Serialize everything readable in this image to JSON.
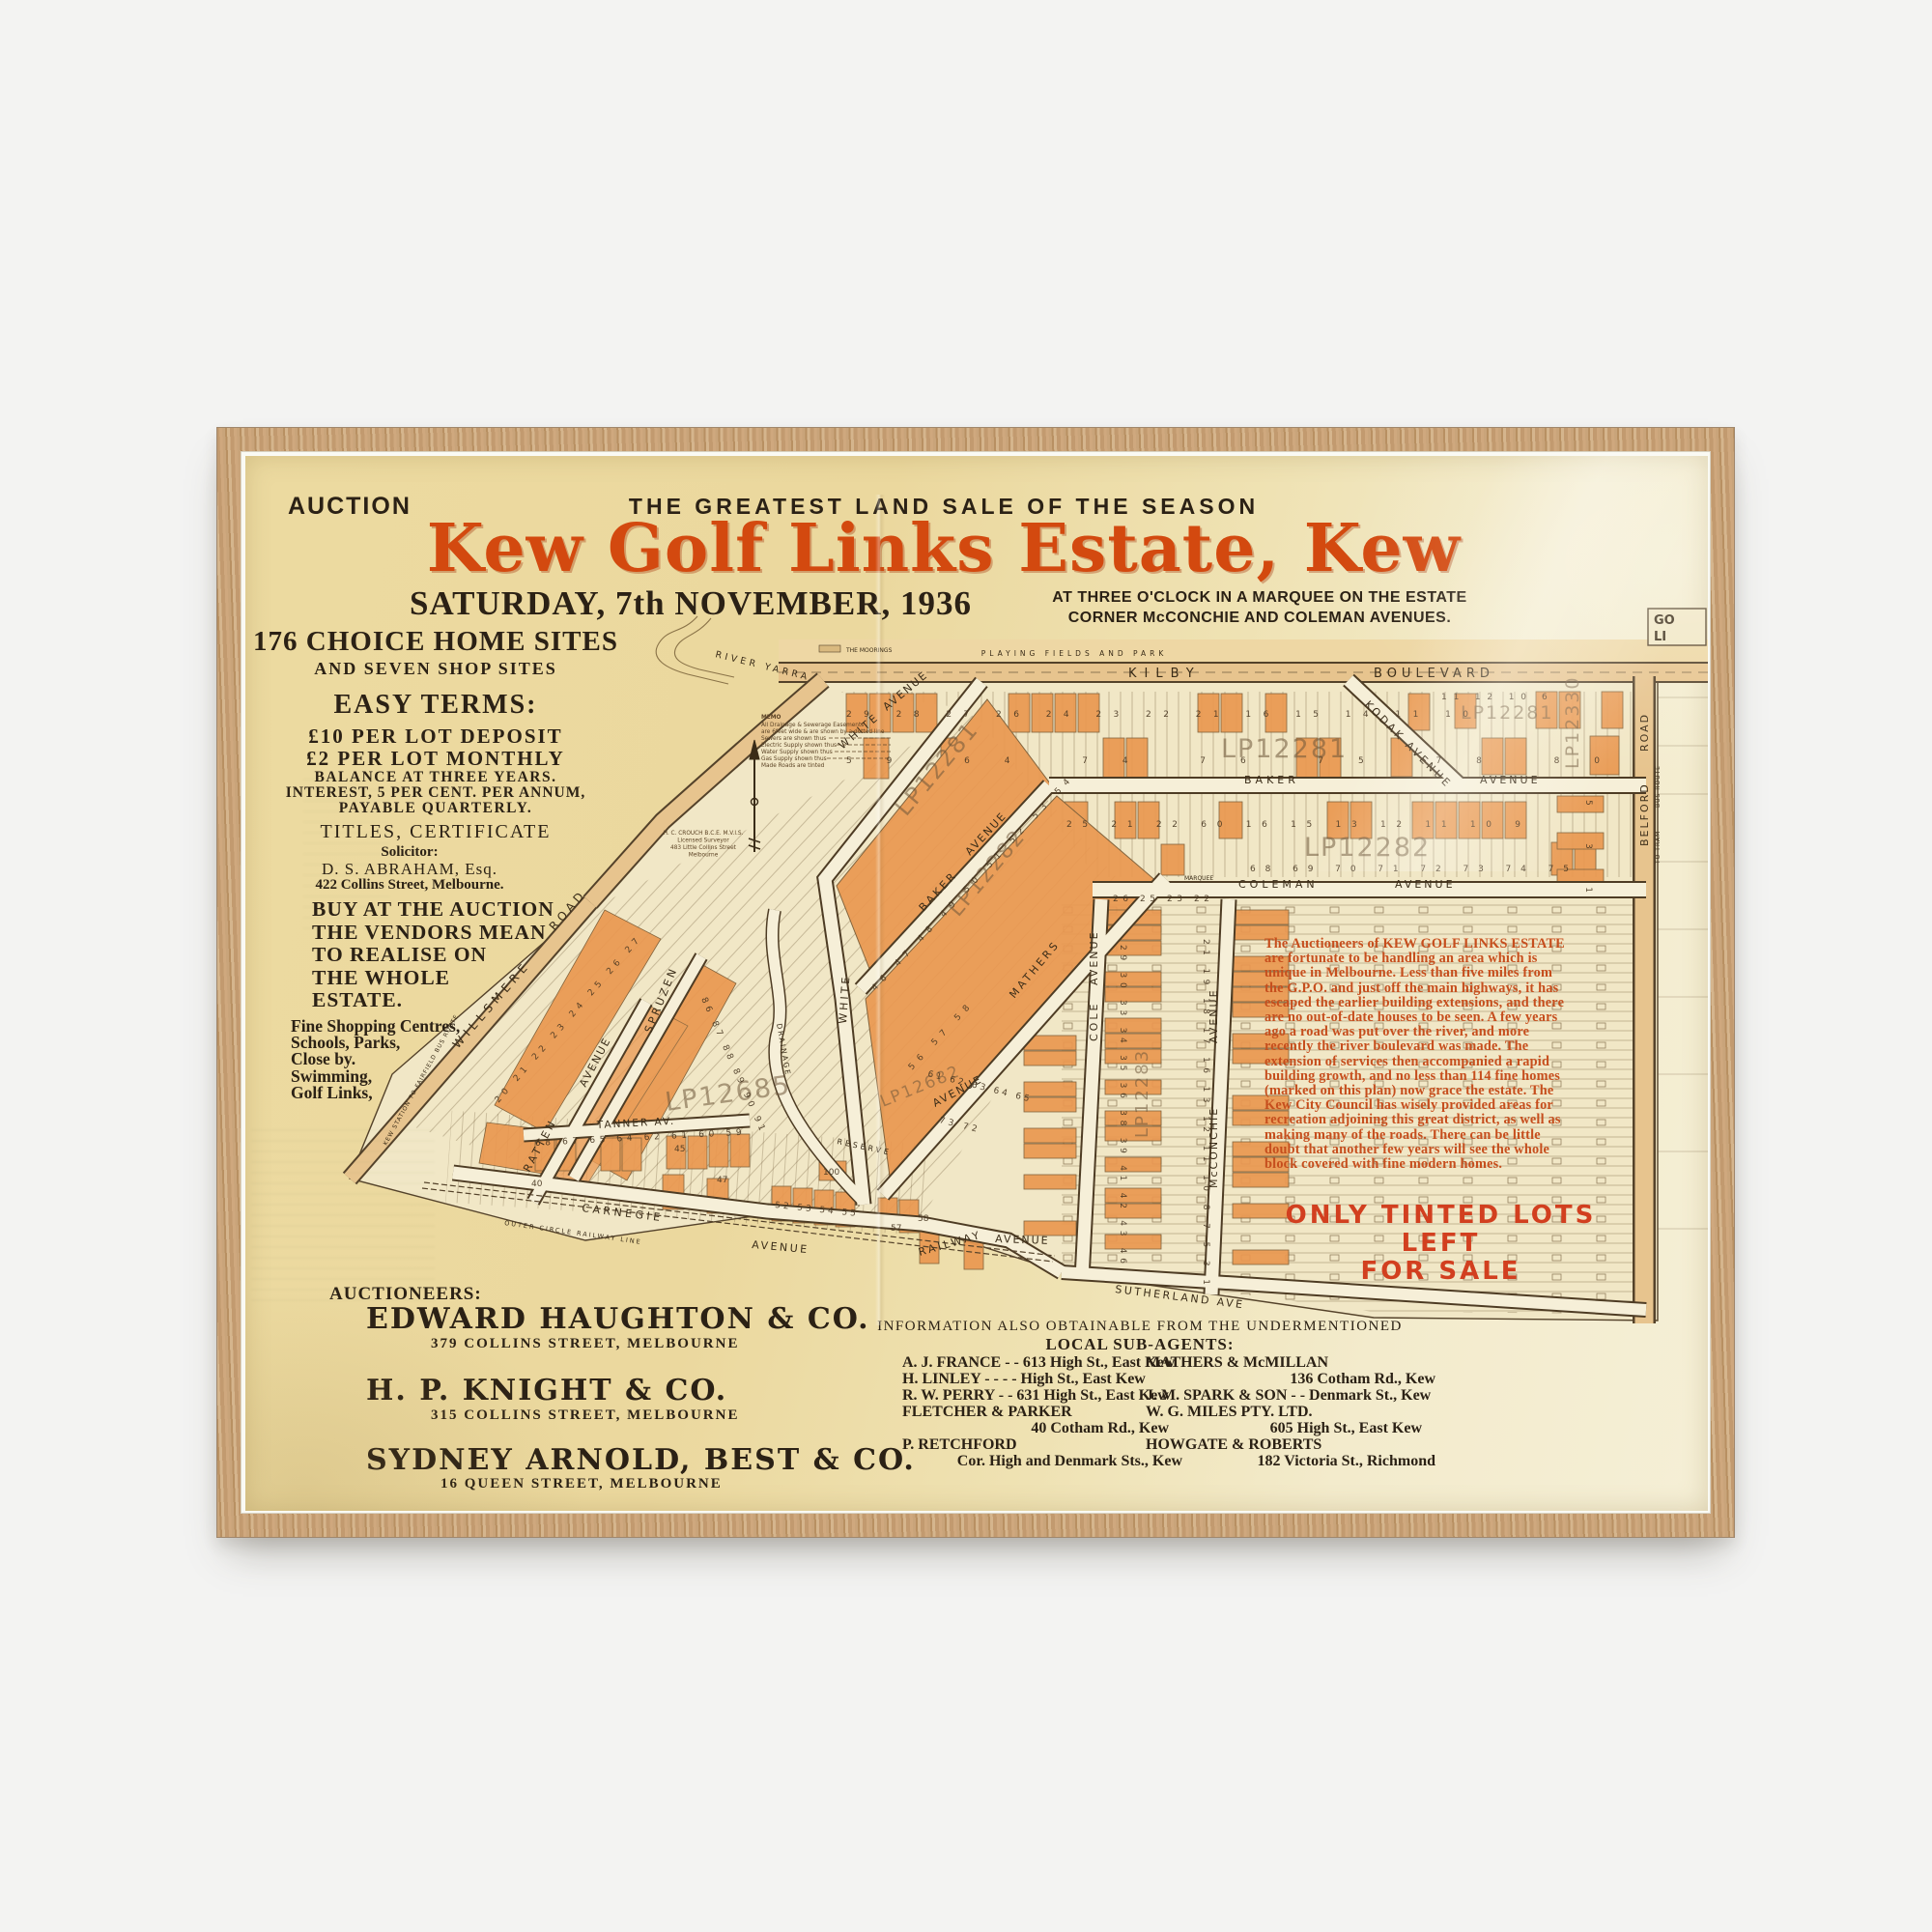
{
  "header": {
    "auction": "AUCTION",
    "tagline": "THE GREATEST LAND SALE OF THE SEASON",
    "title": "Kew Golf Links Estate, Kew",
    "date": "SATURDAY, 7th NOVEMBER, 1936",
    "time_lines": [
      "AT THREE O'CLOCK IN A MARQUEE ON THE ESTATE",
      "CORNER McCONCHIE AND COLEMAN AVENUES."
    ]
  },
  "left": {
    "sites_heading": "176 CHOICE HOME SITES",
    "sites_sub": "AND SEVEN SHOP SITES",
    "easy_terms": "EASY TERMS:",
    "deposit": "£10 PER LOT DEPOSIT",
    "monthly": "£2 PER LOT MONTHLY",
    "balance": "BALANCE AT THREE YEARS.",
    "interest": "INTEREST, 5 PER CENT. PER ANNUM,",
    "payable": "PAYABLE QUARTERLY.",
    "titles": "TITLES, CERTIFICATE",
    "solicitor_label": "Solicitor:",
    "solicitor_name": "D. S. ABRAHAM, Esq.",
    "solicitor_address": "422 Collins Street, Melbourne.",
    "buy_lines": [
      "BUY AT THE AUCTION",
      "THE VENDORS MEAN",
      "TO REALISE ON",
      "THE WHOLE",
      "ESTATE."
    ],
    "amenities_lines": [
      "Fine Shopping Centres,",
      "Schools, Parks,",
      "Close by.",
      "Swimming,",
      "Golf Links,"
    ]
  },
  "auctioneers": {
    "heading": "AUCTIONEERS:",
    "firms": [
      {
        "name": "EDWARD HAUGHTON & CO.",
        "address": "379 COLLINS STREET, MELBOURNE"
      },
      {
        "name": "H. P. KNIGHT & CO.",
        "address": "315 COLLINS STREET, MELBOURNE"
      },
      {
        "name": "SYDNEY ARNOLD, BEST & CO.",
        "address": "16 QUEEN STREET, MELBOURNE"
      }
    ]
  },
  "agents": {
    "info_line": "INFORMATION ALSO OBTAINABLE FROM THE UNDERMENTIONED",
    "heading": "LOCAL SUB-AGENTS:",
    "left": [
      "A. J. FRANCE -  - 613 High St., East Kew",
      "H. LINLEY -  -  -  - High St., East Kew",
      "R. W. PERRY -  - 631 High St., East Kew",
      "FLETCHER & PARKER",
      "40 Cotham Rd., Kew",
      "P. RETCHFORD",
      "Cor. High and Denmark Sts., Kew"
    ],
    "right": [
      "MATHERS & McMILLAN",
      "136 Cotham Rd., Kew",
      "J. M. SPARK & SON -  - Denmark St., Kew",
      "W. G. MILES PTY. LTD.",
      "605 High St., East Kew",
      "HOWGATE & ROBERTS",
      "182 Victoria St., Richmond"
    ]
  },
  "map": {
    "playing_fields": "PLAYING FIELDS AND PARK",
    "river_yarra": "RIVER YARRA",
    "moorings": "THE MOORINGS",
    "kilby": "KILBY",
    "boulevard": "BOULEVARD",
    "kodak": "KODAK AVENUE",
    "baker": "BAKER",
    "coleman": "COLEMAN",
    "marquee": "MARQUEE",
    "avenue_word": "AVENUE",
    "road_word": "ROAD",
    "white": "WHITE",
    "mathers": "MATHERS",
    "cole": "COLE",
    "mcconchie": "McCONCHIE",
    "belford": "BELFORD",
    "bus_route": "BUS ROUTE",
    "to_tram": "TO TRAM",
    "golf_lines": [
      "GO",
      "LI"
    ],
    "sutherland": "SUTHERLAND AVE",
    "railway": "RAILWAY",
    "carnegie": "CARNEGIE",
    "outer_circle": "OUTER CIRCLE RAILWAY LINE",
    "tanner": "TANNER AV.",
    "ratten": "RATTEN",
    "spruzen": "SPRUZEN",
    "willsmere": "WILLSMERE",
    "kew_bus_route": "KEW STATION TO FAIRFIELD BUS ROUTE",
    "drainage": "DRAINAGE",
    "reserve": "RESERVE",
    "lp1": "LP12281",
    "lp2": "LP12282",
    "lp3": "LP12283",
    "lp4": "LP12330",
    "lp5": "LP12685",
    "lp6": "LP12682",
    "memo_lines": [
      "MEMO",
      "All Drainage & Sewerage Easements",
      "are 6feet wide & are shown by a dotted line",
      "Sewers are shown thus",
      "Electric Supply shown thus",
      "Water Supply shown thus",
      "Gas Supply shown thus",
      "Made Roads are tinted"
    ],
    "surveyor_lines": [
      "H. C. CROUCH B.C.E. M.V.I.S.",
      "Licensed Surveyor",
      "483 Little Collins Street",
      "Melbourne"
    ],
    "paragraph_lines": [
      "The Auctioneers of KEW GOLF LINKS ESTATE",
      "are fortunate to be handling an area which is",
      "unique in Melbourne.  Less than five miles from",
      "the G.P.O. and just off the main highways, it has",
      "escaped the earlier building extensions, and there",
      "are no out-of-date houses to be seen.  A few years",
      "ago a road was put over the river, and more",
      "recently the river boulevard was made.  The",
      "extension of services then accompanied a rapid",
      "building growth, and no less than 114 fine homes",
      "(marked on this plan) now grace the estate.  The",
      "Kew City Council has wisely provided areas for",
      "recreation adjoining this great district, as well as",
      "making many of the roads.  There can be little",
      "doubt that another few years will see the whole",
      "block covered with fine modern homes."
    ],
    "notice_lines": [
      "ONLY TINTED LOTS LEFT",
      "FOR SALE"
    ],
    "lot_rows": {
      "r1": "29 28 27 26 24 23 22 21 16 15 14 11 10",
      "r2": "59 64 74 76 75 78 80",
      "r3": "25 21 22 60 16 15 13 12 11 10 9",
      "r4": "68 69 70 71 72 73 74 75",
      "r5": "46 47 48 49 50 51 52 53 54",
      "r6": "56 57 58",
      "r7": "61 62 63 64 65",
      "r8": "73 72",
      "r9": "26 25 23 22",
      "r10": "29 30 33 34 35 36 38 39 41 42 43 46",
      "r11": "21 19 18 17 16 13 12 11 10 8 7 5 3 1",
      "r12": "68 67 65 64 62 61 60 59",
      "r13": "52 53 54 55",
      "r14": "20 21 22 23 24 25 26 27",
      "r15": "86 87 88 89 90 91",
      "r16": "11 12 10",
      "r17": "5 3 1"
    },
    "lot_singles": {
      "s1": "45",
      "s2": "47",
      "s3": "57",
      "s4": "58",
      "s5": "100",
      "s6": "40",
      "s8": "6"
    }
  },
  "colors": {
    "paper": "#ecda9f",
    "accent_orange": "#d3490f",
    "map_text_red": "#c64e1d",
    "notice_red": "#d23f1f",
    "lot_tint": "#ea9850",
    "wood": "#c6a078",
    "ink": "#2b2115"
  }
}
